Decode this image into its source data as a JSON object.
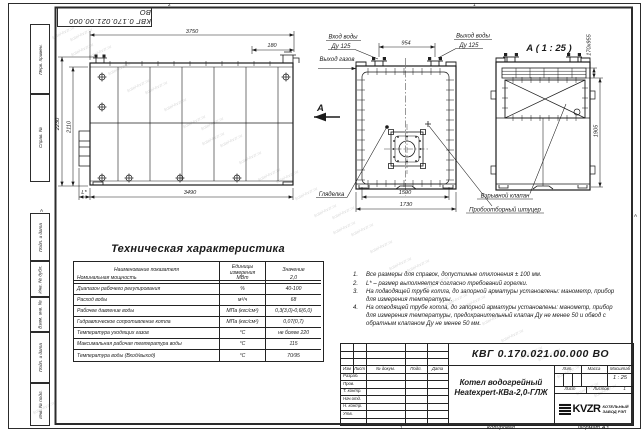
{
  "frame": {
    "top_doc_box": "КВГ 0.170.021.00.000 ВО",
    "left_columns": [
      "Перв. примен.",
      "Справ. №",
      "Подп. и дата",
      "Инв. № дубл.",
      "Взам. инв. №",
      "Подп. и дата",
      "Инв. № подл."
    ],
    "zone_top_left": "2",
    "zone_top_right": "1",
    "zone_left": "А",
    "zone_right": "А",
    "zone_bottom": "1",
    "copied_by": "Копировал",
    "format": "Формат А3"
  },
  "side_view": {
    "dim_3750": "3750",
    "dim_180": "180",
    "dim_2230": "2230",
    "dim_2110": "2110",
    "dim_3490": "3490",
    "dim_l": "L*",
    "section_letter": "А"
  },
  "front_view": {
    "label_water_in_1": "Вход воды",
    "label_water_in_2": "Ду 125",
    "label_water_out_1": "Выход воды",
    "label_water_out_2": "Ду 125",
    "label_gas_out": "Выход газов",
    "label_sight_glass": "Гляделка",
    "label_sampling_port": "Пробоотборный штуцер",
    "dim_954": "954",
    "dim_1590": "1590",
    "dim_1730": "1730"
  },
  "detail_view": {
    "title": "А ( 1 : 25 )",
    "label_explosion_valve": "Взрывной клапан",
    "dim_170x955": "170х955",
    "dim_1905": "1905"
  },
  "spec_table": {
    "title": "Техническая характеристика",
    "headers": [
      "Наименование показателя",
      "Единицы измерения",
      "Значение"
    ],
    "rows": [
      {
        "name": "Номинальная мощность",
        "unit": "МВт",
        "value": "2,0"
      },
      {
        "name": "Диапазон рабочего регулирования",
        "unit": "%",
        "value": "40-100"
      },
      {
        "name": "Расход воды",
        "unit": "м³/ч",
        "value": "68"
      },
      {
        "name": "Рабочее давление воды",
        "unit": "МПа (кгс/см²)",
        "value": "0,3(3,0)-0,6(6,0)"
      },
      {
        "name": "Гидравлическое сопротивление котла",
        "unit": "МПа (кгс/см²)",
        "value": "0,07(0,7)"
      },
      {
        "name": "Температура уходящих газов",
        "unit": "°С",
        "value": "не более 220"
      },
      {
        "name": "Максимальная рабочая температура воды",
        "unit": "°С",
        "value": "115"
      },
      {
        "name": "Температура воды (Вход/выход)",
        "unit": "°С",
        "value": "70/95"
      }
    ]
  },
  "notes": [
    {
      "num": "1.",
      "text": "Все размеры для справок, допустимые отклонения ± 100 мм."
    },
    {
      "num": "2.",
      "text": "L* – размер выполняется согласно требований горелки."
    },
    {
      "num": "3.",
      "text": "На подводящей трубе котла, до запорной арматуры установлены: манометр, прибор для измерения температуры."
    },
    {
      "num": "4.",
      "text": "На отводящей трубе котла, до запорной арматуры установлены: манометр, прибор для измерения температуры, предохранительный клапан Ду не менее 50 и обвод с обратным клапаном Ду не менее 50 мм."
    }
  ],
  "title_block": {
    "doc_number": "КВГ 0.170.021.00.000 ВО",
    "product_name_line1": "Котел водогрейный",
    "product_name_line2": "Heatexpert-КВа-2,0-ГЛЖ",
    "header_cols": [
      "Изм",
      "Лист",
      "№ докум.",
      "Подп.",
      "Дата"
    ],
    "row_labels": [
      "Разраб.",
      "Пров.",
      "Т. контр.",
      "Нач.отд.",
      "Н. контр.",
      "Утв."
    ],
    "lit_label": "Лит.",
    "mass_label": "Масса",
    "scale_label": "Масштаб",
    "scale_value": "1 : 25",
    "sheet_label": "Лист",
    "sheets_label": "Листов",
    "sheets_value": "1",
    "company_logo": "KVZR",
    "company_name_line1": "КОТЕЛЬНЫЙ",
    "company_name_line2": "ЗАВОД РЭП"
  },
  "watermark_text": "kotel-kvzr.ru"
}
